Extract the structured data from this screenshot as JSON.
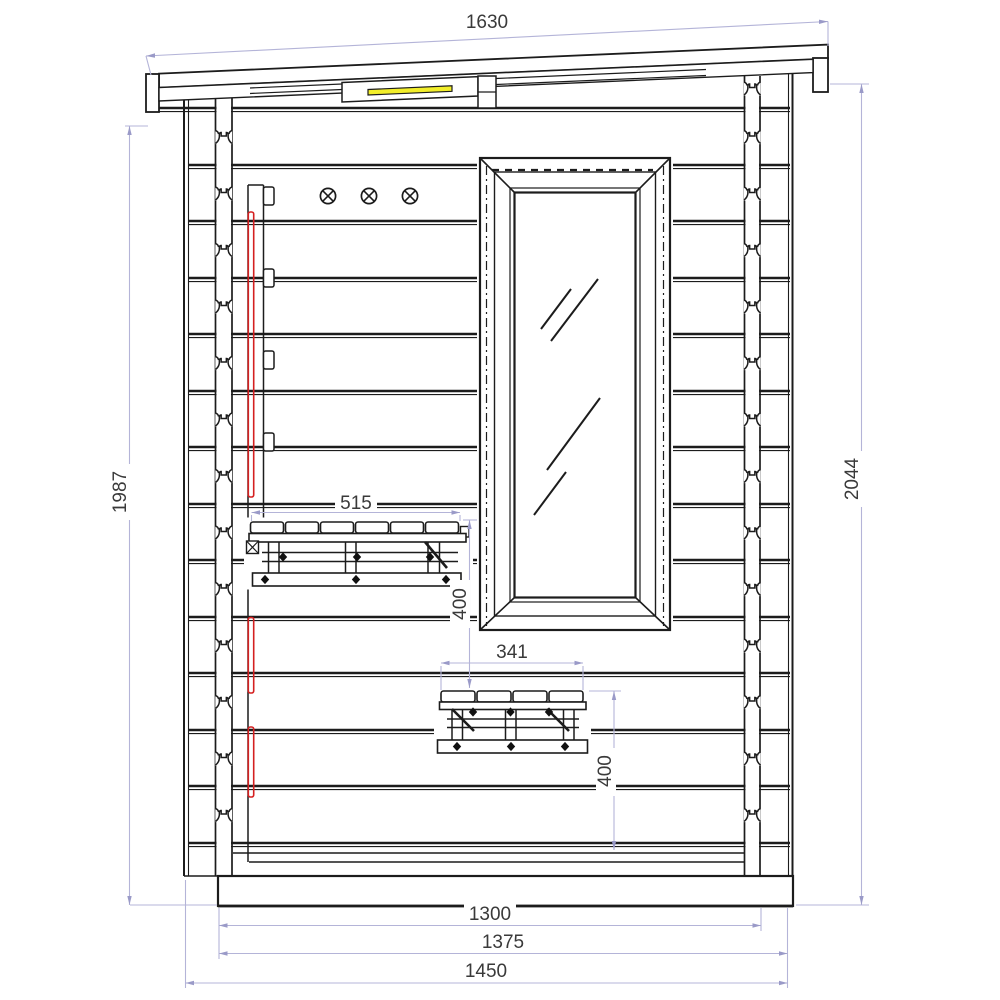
{
  "drawing": {
    "dimensions": {
      "roof_width": "1630",
      "left_height": "1987",
      "right_height": "2044",
      "upper_bench_width": "515",
      "upper_bench_height": "400",
      "lower_bench_width": "341",
      "lower_bench_height": "400",
      "floor_inner_width": "1300",
      "base_mid_width": "1375",
      "base_overall_width": "1450"
    },
    "colors": {
      "line": "#1c1c1c",
      "dimension_line": "#b4b4d8",
      "dimension_text": "#3a3a3a",
      "light_strip_yellow": "#f2ee2a",
      "safety_guard_red": "#d42020",
      "background": "#ffffff"
    }
  }
}
